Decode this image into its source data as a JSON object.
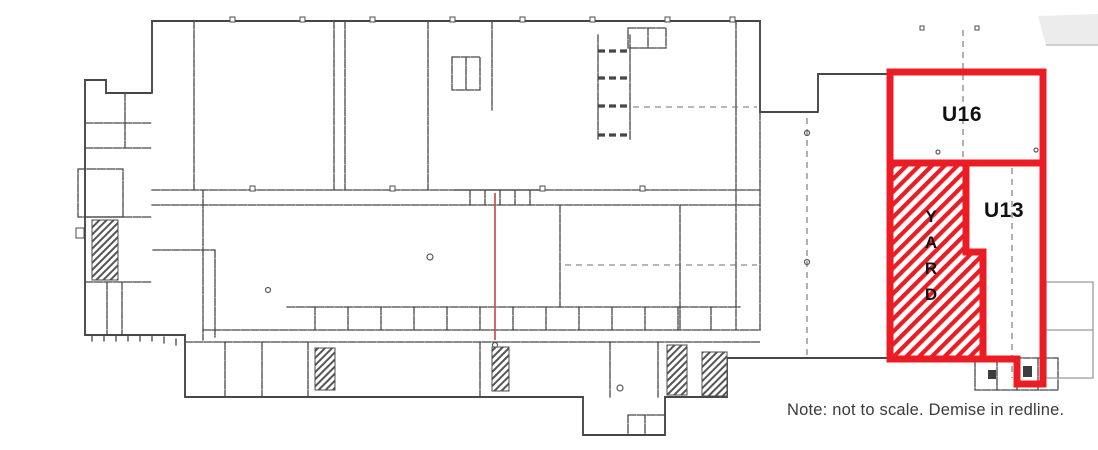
{
  "page": {
    "title": "Floor plan with demise outline",
    "background": "#ffffff"
  },
  "plan": {
    "units": [
      {
        "id": "U16",
        "label": "U16"
      },
      {
        "id": "U13",
        "label": "U13"
      }
    ],
    "yard": {
      "label": "YARD",
      "letters": [
        "Y",
        "A",
        "R",
        "D"
      ]
    },
    "note": "Note: not to scale. Demise in redline.",
    "colors": {
      "demise_red": "#ec1c24",
      "plan_line": "#474747",
      "plan_line_light": "#9b9b9b",
      "corner_fill": "#ececec",
      "partition_red": "#c9504e",
      "note_text": "#3b3b3b",
      "label_text": "#111111",
      "background": "#ffffff"
    }
  }
}
